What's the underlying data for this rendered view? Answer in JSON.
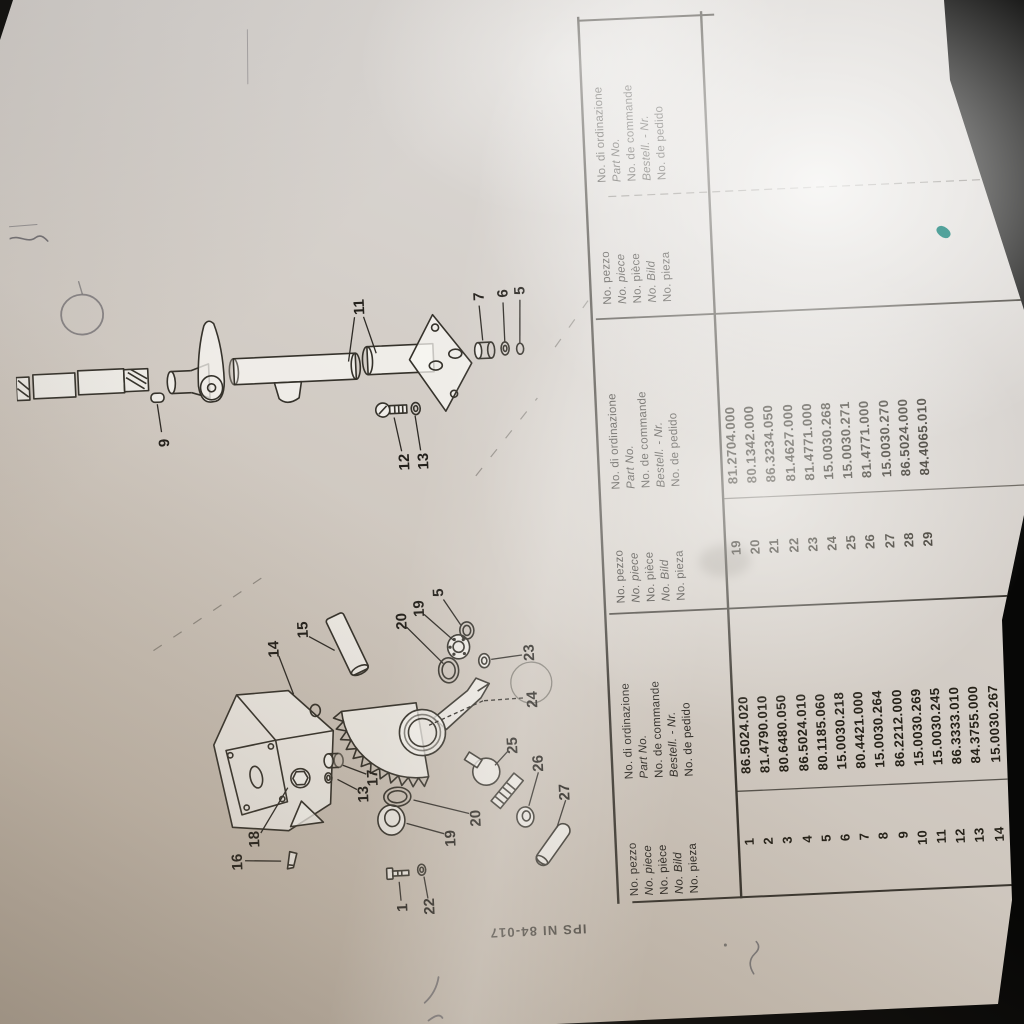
{
  "stamp": "IPS NI 84-017",
  "table": {
    "no_header": [
      "No. pezzo",
      "No. piece",
      "No. pièce",
      "No. Bild",
      "No. pieza"
    ],
    "part_header": [
      "No. di ordinazione",
      "Part No.",
      "No. de commande",
      "Bestell. - Nr.",
      "No. de pedido"
    ],
    "groups": [
      {
        "rows": [
          {
            "no": "1",
            "part": "86.5024.020"
          },
          {
            "no": "2",
            "part": "81.4790.010"
          },
          {
            "no": "3",
            "part": "80.6480.050"
          },
          {
            "no": "4",
            "part": "86.5024.010"
          },
          {
            "no": "5",
            "part": "80.1185.060"
          },
          {
            "no": "6",
            "part": "15.0030.218"
          },
          {
            "no": "7",
            "part": "80.4421.000"
          },
          {
            "no": "8",
            "part": "15.0030.264"
          },
          {
            "no": "9",
            "part": "86.2212.000"
          },
          {
            "no": "10",
            "part": "15.0030.269"
          },
          {
            "no": "11",
            "part": "15.0030.245"
          },
          {
            "no": "12",
            "part": "86.3333.010"
          },
          {
            "no": "13",
            "part": "84.3755.000"
          },
          {
            "no": "14",
            "part": "15.0030.267"
          },
          {
            "no": "15",
            "part": "15.0030.265"
          }
        ]
      },
      {
        "rows": [
          {
            "no": "19",
            "part": "81.2704.000"
          },
          {
            "no": "20",
            "part": "80.1342.000"
          },
          {
            "no": "21",
            "part": "86.3234.050"
          },
          {
            "no": "22",
            "part": "81.4627.000"
          },
          {
            "no": "23",
            "part": "81.4771.000"
          },
          {
            "no": "24",
            "part": "15.0030.268"
          },
          {
            "no": "25",
            "part": "15.0030.271"
          },
          {
            "no": "26",
            "part": "81.4771.000"
          },
          {
            "no": "27",
            "part": "15.0030.270"
          },
          {
            "no": "28",
            "part": "86.5024.000"
          },
          {
            "no": "29",
            "part": "84.4065.010"
          }
        ]
      },
      {
        "rows": []
      }
    ]
  },
  "diagram": {
    "callouts": [
      {
        "label": "9",
        "x": 601,
        "y": 146,
        "leads": [
          [
            612,
            143,
            640,
            140
          ]
        ]
      },
      {
        "label": "11",
        "x": 728,
        "y": 347,
        "leads": [
          [
            718,
            341,
            674,
            333
          ],
          [
            718,
            350,
            681,
            361
          ]
        ]
      },
      {
        "label": "7",
        "x": 733,
        "y": 467,
        "leads": [
          [
            724,
            466,
            689,
            468
          ]
        ]
      },
      {
        "label": "6",
        "x": 735,
        "y": 491,
        "leads": [
          [
            726,
            490,
            687,
            490
          ]
        ]
      },
      {
        "label": "5",
        "x": 737,
        "y": 508,
        "leads": [
          [
            728,
            507,
            685,
            505
          ]
        ]
      },
      {
        "label": "12",
        "x": 571,
        "y": 385,
        "leads": [
          [
            582,
            382,
            616,
            376
          ]
        ]
      },
      {
        "label": "13",
        "x": 571,
        "y": 404,
        "leads": [
          [
            582,
            401,
            617,
            397
          ]
        ]
      },
      {
        "label": "14",
        "x": 390,
        "y": 246,
        "leads": [
          [
            383,
            250,
            344,
            263
          ]
        ]
      },
      {
        "label": "15",
        "x": 408,
        "y": 276,
        "leads": [
          [
            401,
            281,
            386,
            306
          ]
        ]
      },
      {
        "label": "20",
        "x": 412,
        "y": 375,
        "leads": [
          [
            406,
            379,
            368,
            414
          ]
        ]
      },
      {
        "label": "19",
        "x": 424,
        "y": 393,
        "leads": [
          [
            418,
            397,
            391,
            425
          ]
        ]
      },
      {
        "label": "5",
        "x": 439,
        "y": 413,
        "leads": [
          [
            432,
            417,
            406,
            433
          ]
        ]
      },
      {
        "label": "23",
        "x": 375,
        "y": 501,
        "leads": [
          [
            373,
            493,
            370,
            462
          ]
        ]
      },
      {
        "label": "24",
        "x": 328,
        "y": 502,
        "dashed": true,
        "leads": [
          [
            330,
            492,
            329,
            452
          ],
          [
            329,
            452,
            307,
            397
          ]
        ]
      },
      {
        "label": "25",
        "x": 283,
        "y": 480,
        "leads": [
          [
            277,
            474,
            264,
            461
          ]
        ]
      },
      {
        "label": "26",
        "x": 264,
        "y": 505,
        "leads": [
          [
            255,
            504,
            222,
            493
          ]
        ]
      },
      {
        "label": "27",
        "x": 234,
        "y": 530,
        "leads": [
          [
            226,
            530,
            199,
            520
          ]
        ]
      },
      {
        "label": "16",
        "x": 179,
        "y": 200,
        "leads": [
          [
            180,
            207,
            178,
            243
          ]
        ]
      },
      {
        "label": "18",
        "x": 201,
        "y": 218,
        "leads": [
          [
            207,
            224,
            251,
            253
          ]
        ]
      },
      {
        "label": "13",
        "x": 241,
        "y": 329,
        "leads": [
          [
            246,
            322,
            257,
            303
          ]
        ]
      },
      {
        "label": "17",
        "x": 257,
        "y": 339,
        "leads": [
          [
            261,
            332,
            271,
            309
          ]
        ]
      },
      {
        "label": "19",
        "x": 193,
        "y": 414,
        "leads": [
          [
            198,
            407,
            210,
            370
          ]
        ]
      },
      {
        "label": "20",
        "x": 212,
        "y": 440,
        "leads": [
          [
            217,
            433,
            233,
            378
          ]
        ]
      },
      {
        "label": "1",
        "x": 126,
        "y": 363,
        "leads": [
          [
            133,
            361,
            152,
            360
          ]
        ]
      },
      {
        "label": "22",
        "x": 126,
        "y": 390,
        "leads": [
          [
            134,
            388,
            156,
            385
          ]
        ]
      }
    ]
  },
  "colors": {
    "paper": "#d8d4cf",
    "ink": "#262219",
    "table_line": "#3a362f",
    "background": "#070706",
    "glare": "#f7f6f3",
    "teal_mark": "#37958d"
  }
}
